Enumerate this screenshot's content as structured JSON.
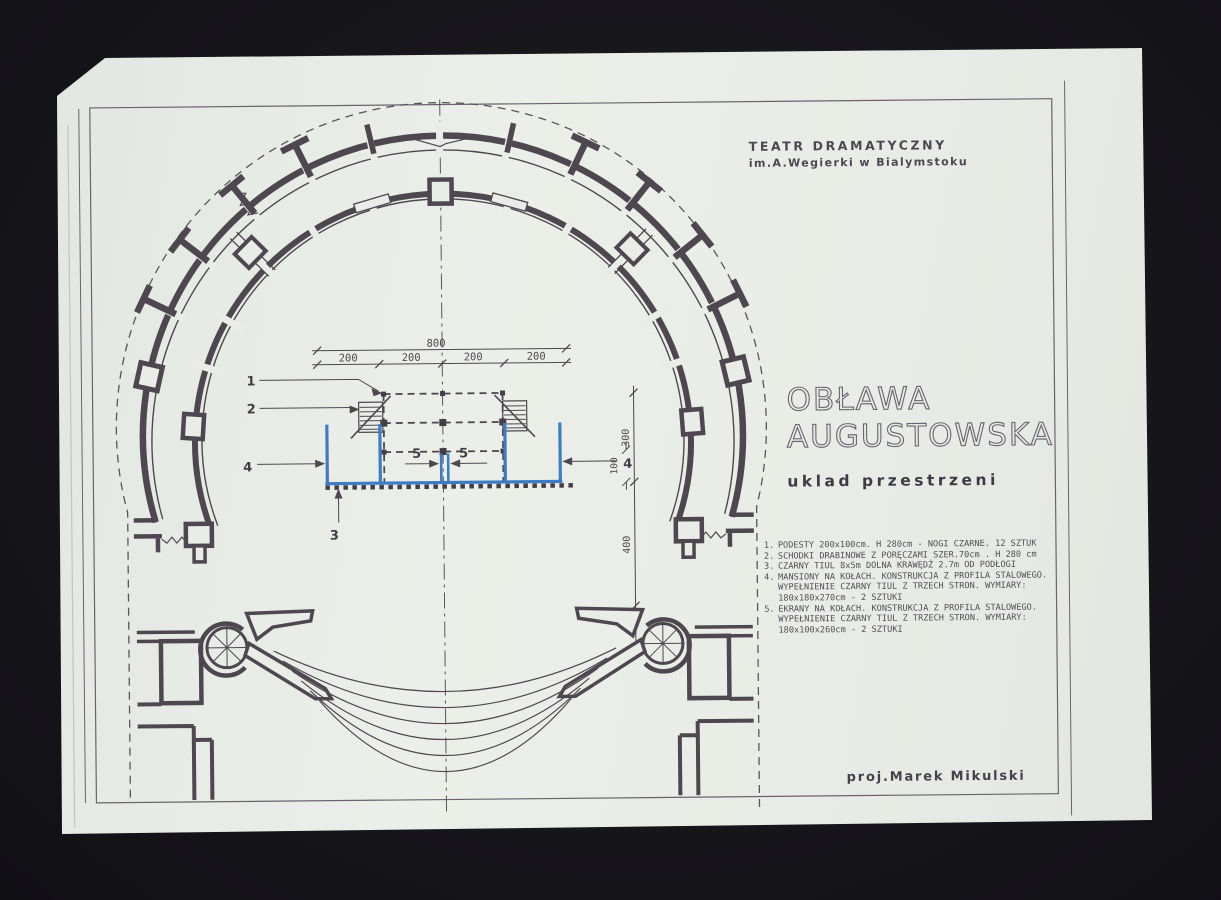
{
  "document": {
    "header": {
      "line1": "TEATR DRAMATYCZNY",
      "line2": "im.A.Wegierki w Bialymstoku"
    },
    "title": {
      "line1": "OBŁAWA",
      "line2": "AUGUSTOWSKA"
    },
    "subtitle": "uklad przestrzeni",
    "legend": {
      "items": [
        {
          "num": "1.",
          "text": "PODESTY 200x100cm. H 280cm - NOGI CZARNE. 12 SZTUK"
        },
        {
          "num": "2.",
          "text": "SCHODKI DRABINOWE Z PORĘCZAMI SZER.70cm . H 280 cm"
        },
        {
          "num": "3.",
          "text": "CZARNY TIUL 8x5m DOLNA KRAWĘDŻ 2.7m OD PODŁOGI"
        },
        {
          "num": "4.",
          "text": "MANSIONY NA KOŁACH. KONSTRUKCJA Z PROFILA STALOWEGO. WYPEŁNIENIE CZARNY TIUL Z TRZECH STRON. WYMIARY: 180x180x270cm - 2 SZTUKI"
        },
        {
          "num": "5.",
          "text": "EKRANY NA KOŁACH. KONSTRUKCJA Z PROFILA STALOWEGO. WYPEŁNIENIE CZARNY TIUL Z TRZECH STRON. WYMIARY: 180x100x260cm - 2 SZTUKI"
        }
      ]
    },
    "credit": "proj.Marek Mikulski",
    "dimensions": {
      "overall": "800",
      "segment": "200",
      "v_top": "300",
      "v_mid": "100",
      "v_bottom": "400"
    },
    "callouts": {
      "c1": "1",
      "c2": "2",
      "c3": "3",
      "c4": "4",
      "c5": "5"
    },
    "colors": {
      "background": "#17161b",
      "paper": "#e9ece7",
      "ink": "#4e4750",
      "blue": "#3d7cc2"
    }
  }
}
